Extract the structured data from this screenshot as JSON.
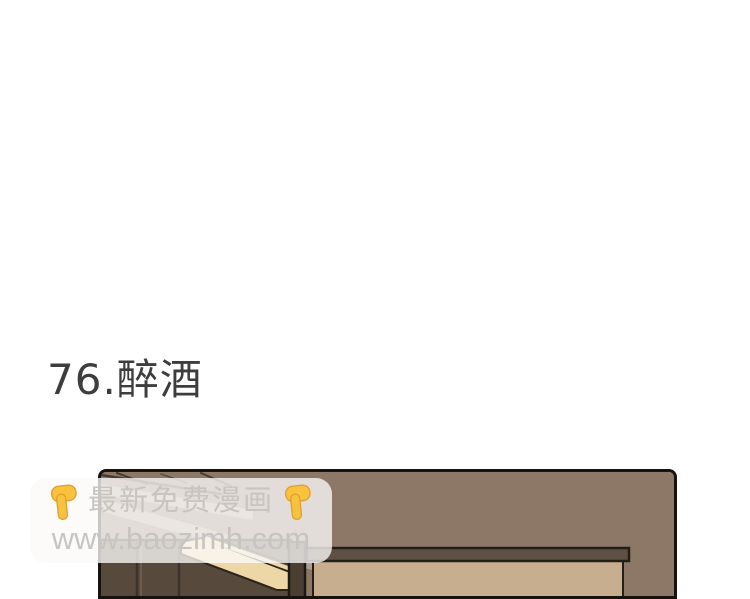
{
  "chapter": {
    "title": "76.醉酒"
  },
  "watermark": {
    "line1": "最新免费漫画",
    "url": "www.baozimh.com",
    "icon": "backhand-index-pointing-down",
    "icon_unicode": "👇"
  },
  "colors": {
    "page-bg": "#ffffff",
    "title": "#3d3d3d",
    "panel-border": "#16120e",
    "wall": "#8d7868",
    "dark-wood": "#57493c",
    "wood-seam": "#75644f",
    "cream": "#eed7a7",
    "beige": "#c7ae8f",
    "band": "#5e5144",
    "wm-box": "rgba(251,250,249,0.78)",
    "wm-text": "#c8c4c1",
    "hand-fill": "#f9c23c",
    "hand-shade": "#dfa032"
  }
}
